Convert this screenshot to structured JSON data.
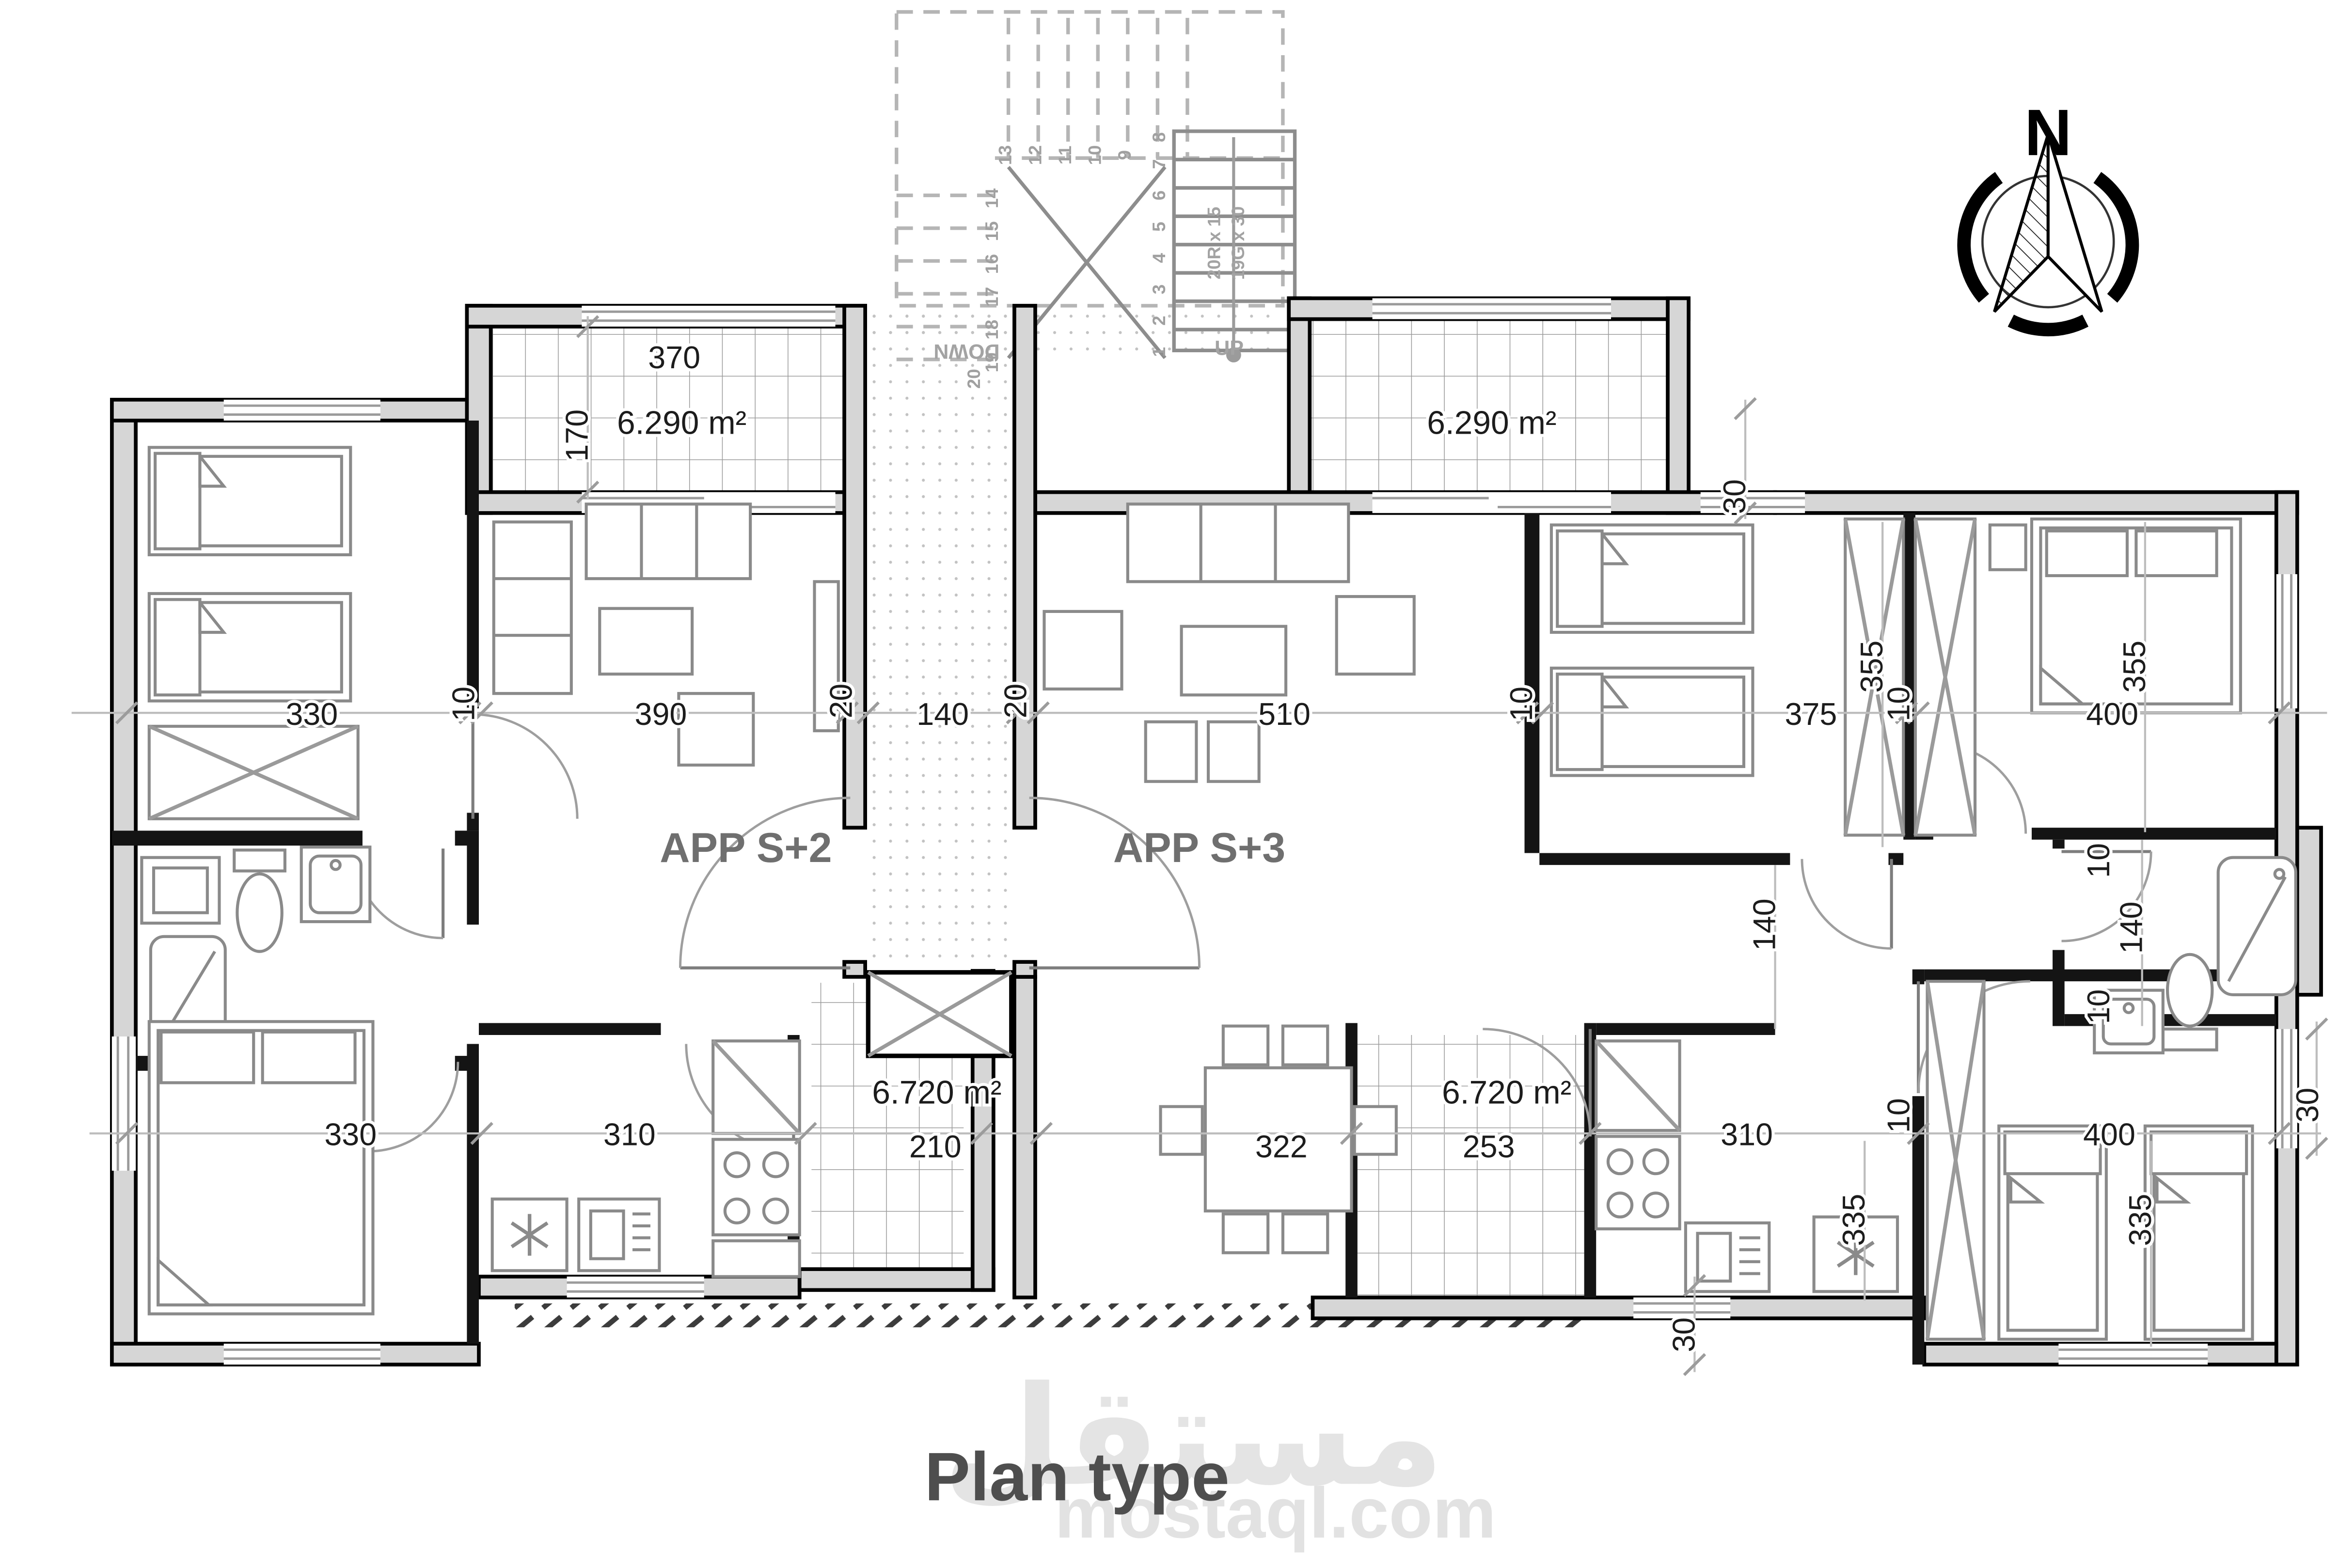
{
  "title_block": {
    "title": "Plan type"
  },
  "watermark": {
    "logo_text": "مستقل",
    "site_text": "mostaql.com"
  },
  "compass": {
    "north_label": "N"
  },
  "apartments": {
    "left": {
      "label": "APP S+2"
    },
    "right": {
      "label": "APP S+3"
    }
  },
  "stairs": {
    "up_label": "UP",
    "down_label": "DOWN",
    "riser_note": "20R x 15",
    "going_note": "19G x 30",
    "steps": [
      "1",
      "2",
      "3",
      "4",
      "5",
      "6",
      "7",
      "8",
      "9",
      "10",
      "11",
      "12",
      "13",
      "14",
      "15",
      "16",
      "17",
      "18",
      "19",
      "20"
    ]
  },
  "areas": {
    "balcony_left": "6.290 m²",
    "balcony_right": "6.290 m²",
    "terrace_left": "6.720 m²",
    "terrace_right": "6.720 m²"
  },
  "dims": [
    "330",
    "10",
    "390",
    "20",
    "140",
    "20",
    "510",
    "10",
    "375",
    "355",
    "10",
    "400",
    "355",
    "330",
    "310",
    "210",
    "322",
    "253",
    "310",
    "10",
    "400",
    "335",
    "335",
    "370",
    "170",
    "30",
    "140",
    "10",
    "140",
    "10",
    "30",
    "30"
  ],
  "colors": {
    "wall_fill": "#d6d6d6",
    "wall_stroke": "#000000",
    "furniture": "#8a8a8a",
    "dim_line": "#bdbdbd",
    "dim_text": "#1c1c1c",
    "label_gray": "#6f6f6f",
    "watermark": "#e3e3e3"
  }
}
